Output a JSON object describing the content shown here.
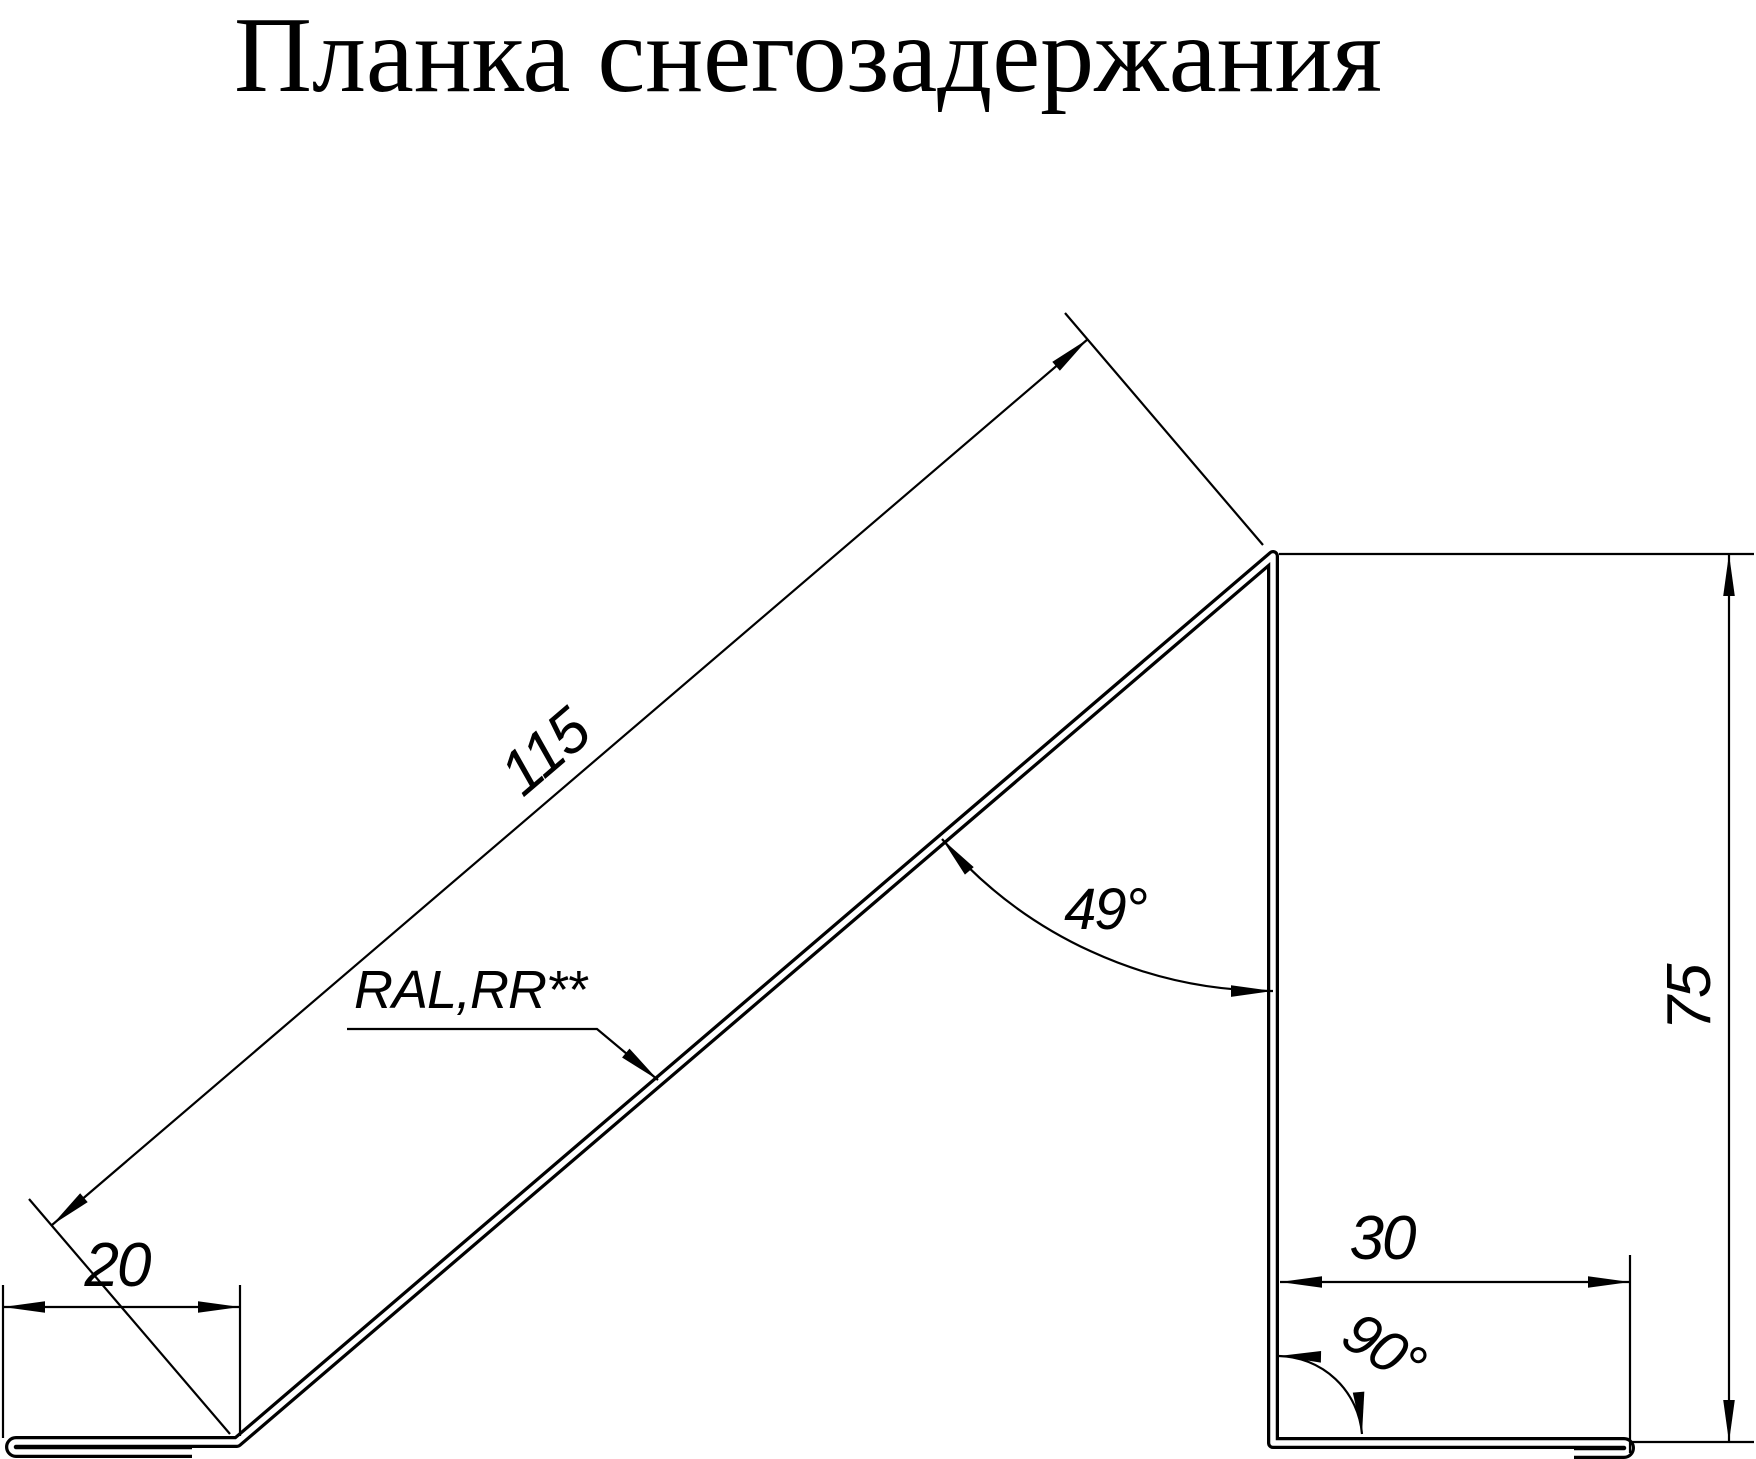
{
  "title": "Планка снегозадержания",
  "labels": {
    "slope_length": "115",
    "left_flange_width": "20",
    "slope_angle": "49°",
    "coating": "RAL,RR**",
    "height": "75",
    "bottom_flange_width": "30",
    "bottom_angle": "90°"
  },
  "colors": {
    "line": "#000000",
    "background": "#ffffff"
  }
}
